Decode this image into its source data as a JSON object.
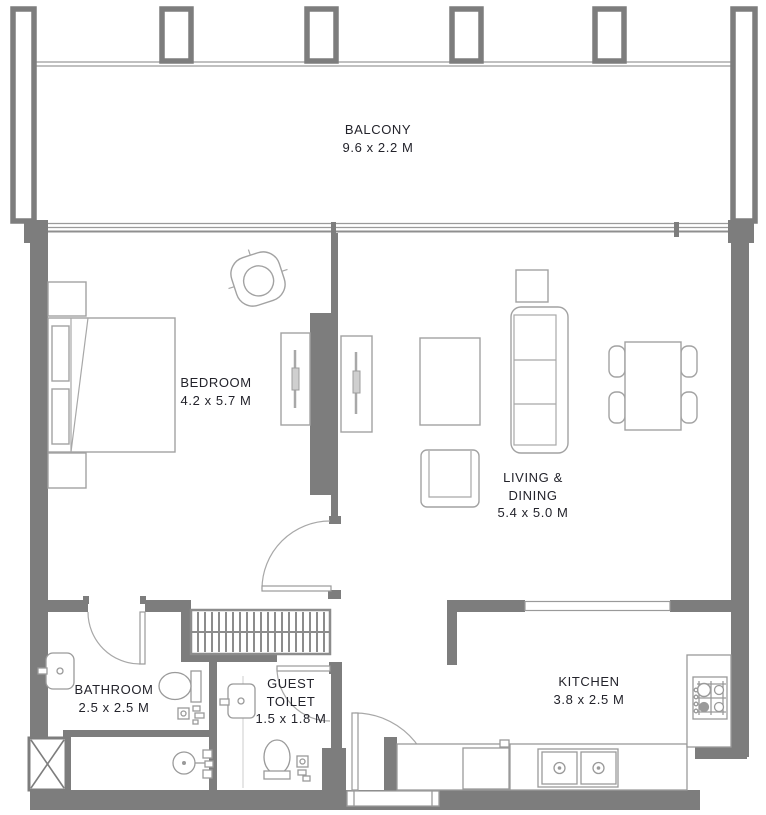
{
  "rooms": {
    "balcony": {
      "label": "BALCONY",
      "dims": "9.6 x 2.2 M"
    },
    "bedroom": {
      "label": "BEDROOM",
      "dims": "4.2 x 5.7 M"
    },
    "living_dining": {
      "label_line1": "LIVING &",
      "label_line2": "DINING",
      "dims": "5.4 x 5.0 M"
    },
    "bathroom": {
      "label": "BATHROOM",
      "dims": "2.5 x 2.5 M"
    },
    "guest_toilet": {
      "label_line1": "GUEST",
      "label_line2": "TOILET",
      "dims": "1.5 x 1.8 M"
    },
    "kitchen": {
      "label": "KITCHEN",
      "dims": "3.8 x 2.5 M"
    }
  },
  "colors": {
    "wall": "#7d7d7d",
    "furniture_line": "#a2a2a2",
    "label_text": "#23232b",
    "background": "#ffffff"
  }
}
